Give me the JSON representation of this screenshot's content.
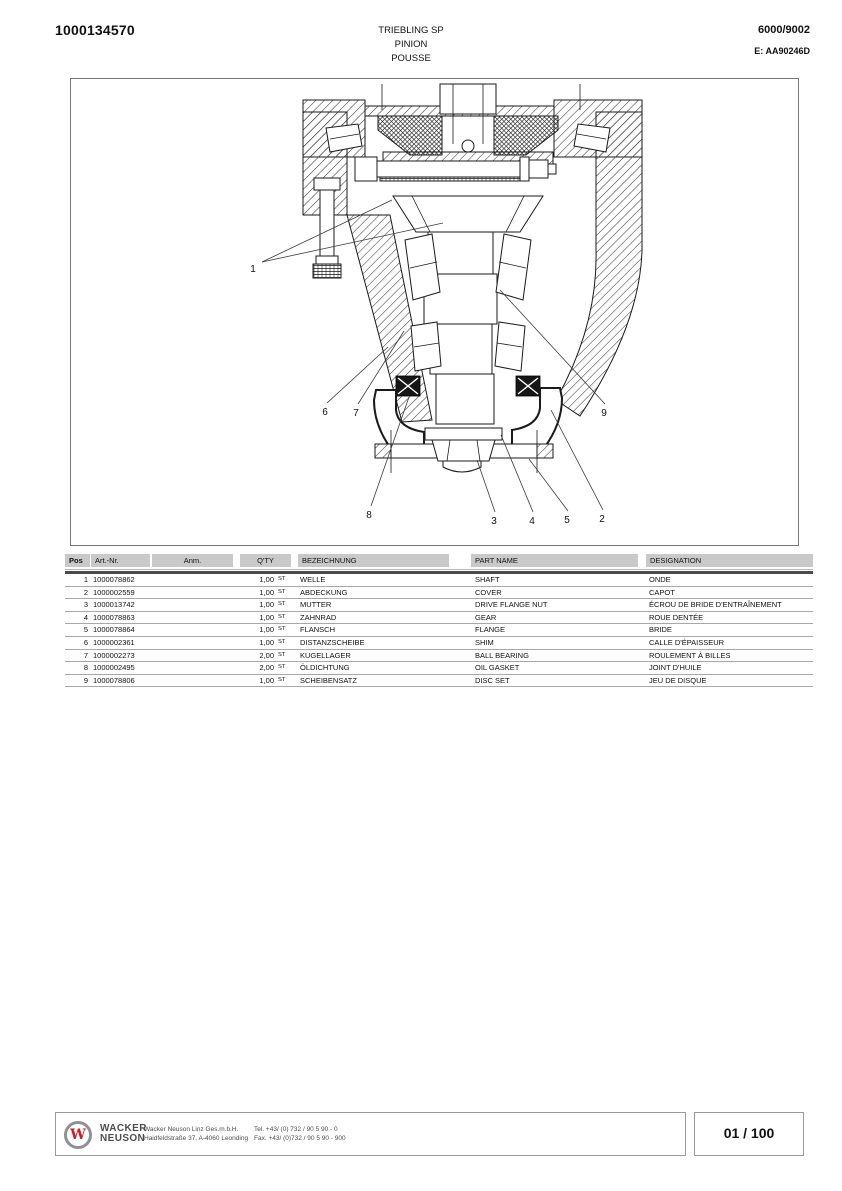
{
  "header": {
    "doc_number": "1000134570",
    "title_lines": [
      "TRIEBLING SP",
      "PINION",
      "POUSSE"
    ],
    "model_no": "6000/9002",
    "edition": "E: AA90246D"
  },
  "diagram": {
    "description": "cross-section-of-pinion-assembly",
    "callouts": [
      {
        "label": "1"
      },
      {
        "label": "2"
      },
      {
        "label": "3"
      },
      {
        "label": "4"
      },
      {
        "label": "5"
      },
      {
        "label": "6"
      },
      {
        "label": "7"
      },
      {
        "label": "8"
      },
      {
        "label": "9"
      }
    ]
  },
  "table": {
    "columns": [
      "Pos",
      "Art.-Nr.",
      "Anm.",
      "Q'TY",
      "BEZEICHNUNG",
      "PART NAME",
      "DESIGNATION"
    ],
    "rows": [
      {
        "pos": "1",
        "art": "1000078862",
        "anm": "",
        "qty": "1,00",
        "unit": "ST",
        "bez": "WELLE",
        "part": "SHAFT",
        "des": "ONDE"
      },
      {
        "pos": "2",
        "art": "1000002559",
        "anm": "",
        "qty": "1,00",
        "unit": "ST",
        "bez": "ABDECKUNG",
        "part": "COVER",
        "des": "CAPOT"
      },
      {
        "pos": "3",
        "art": "1000013742",
        "anm": "",
        "qty": "1,00",
        "unit": "ST",
        "bez": "MUTTER",
        "part": "DRIVE FLANGE NUT",
        "des": "ÉCROU DE BRIDE D'ENTRAÎNEMENT"
      },
      {
        "pos": "4",
        "art": "1000078863",
        "anm": "",
        "qty": "1,00",
        "unit": "ST",
        "bez": "ZAHNRAD",
        "part": "GEAR",
        "des": "ROUE DENTÉE"
      },
      {
        "pos": "5",
        "art": "1000078864",
        "anm": "",
        "qty": "1,00",
        "unit": "ST",
        "bez": "FLANSCH",
        "part": "FLANGE",
        "des": "BRIDE"
      },
      {
        "pos": "6",
        "art": "1000002361",
        "anm": "",
        "qty": "1,00",
        "unit": "ST",
        "bez": "DISTANZSCHEIBE",
        "part": "SHIM",
        "des": "CALLE D'ÉPAISSEUR"
      },
      {
        "pos": "7",
        "art": "1000002273",
        "anm": "",
        "qty": "2,00",
        "unit": "ST",
        "bez": "KUGELLAGER",
        "part": "BALL BEARING",
        "des": "ROULEMENT À BILLES"
      },
      {
        "pos": "8",
        "art": "1000002495",
        "anm": "",
        "qty": "2,00",
        "unit": "ST",
        "bez": "ÖLDICHTUNG",
        "part": "OIL GASKET",
        "des": "JOINT D'HUILE"
      },
      {
        "pos": "9",
        "art": "1000078806",
        "anm": "",
        "qty": "1,00",
        "unit": "ST",
        "bez": "SCHEIBENSATZ",
        "part": "DISC SET",
        "des": "JEU DE DISQUE"
      }
    ]
  },
  "footer": {
    "logo_letter": "W",
    "brand_line1": "WACKER",
    "brand_line2": "NEUSON",
    "company": "Wacker Neuson Linz  Ges.m.b.H.",
    "address": "Haidfeldstraße 37, A-4060 Leonding",
    "tel": "Tel. +43/ (0) 732 / 90 5 90 - 0",
    "fax": "Fax. +43/ (0)732 / 90 5 90 - 900",
    "page_indicator": "01 / 100"
  },
  "colors": {
    "accent_red": "#c42127",
    "brand_gray": "#4d4d4f",
    "table_header_gray": "#c9c9c9",
    "rule_dark": "#4a4a4a",
    "rule_light": "#a8a8a8"
  }
}
